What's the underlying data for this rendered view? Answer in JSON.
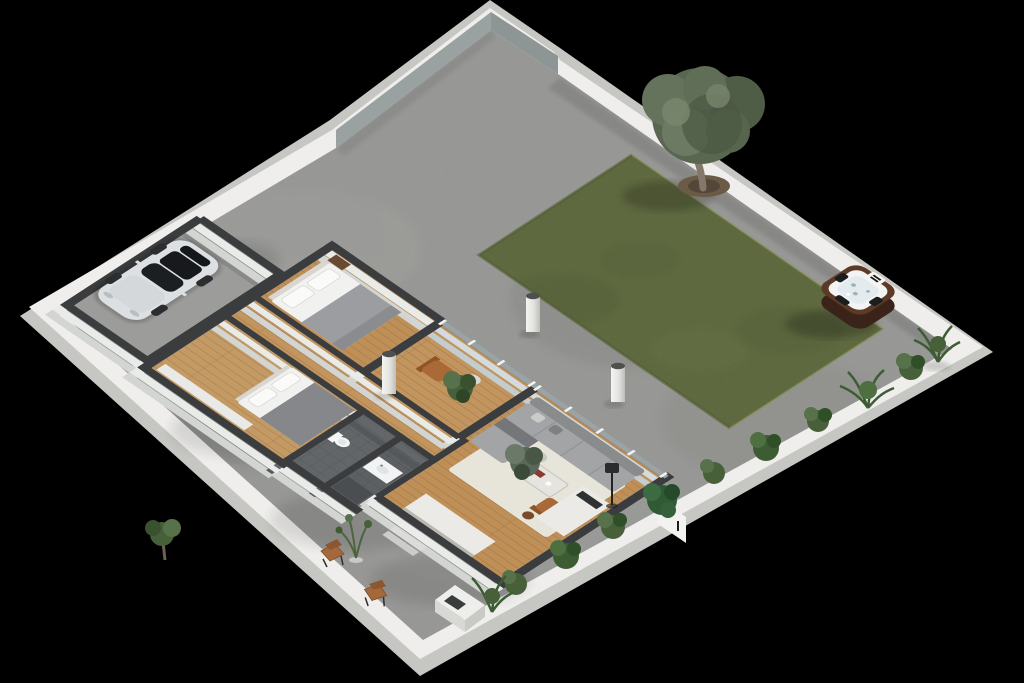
{
  "scene": {
    "type": "3d-isometric-floor-plan-render",
    "view": "Isometric cutaway render of a walled residential lot with house, garage, courtyard, lawn, olive tree and hot tub",
    "background": "#000000",
    "palette": {
      "wall_top": "#efeeec",
      "wall_face": "#c6c6c2",
      "wall_inner_grey": "#8d9595",
      "concrete": "#a8a8a5",
      "grass": "#6f7f3e",
      "grass_dark": "#4c5b2b",
      "tree_canopy": "#5a6750",
      "tree_trunk": "#84786a",
      "soil": "#6b5a45",
      "house_wall_cap": "#3a3c3e",
      "house_wall_face": "#e8eae8",
      "glass": "#c3cdd0",
      "wood_floor": "#bf8f58",
      "bath_tile": "#626668",
      "rug": "#e7e4da",
      "sofa": "#a2a4a6",
      "sofa_back": "#898b8d",
      "linen": "#f1f1ef",
      "blanket": "#9b9da0",
      "blanket_dark": "#85878a",
      "headboard": "#d8d6d2",
      "nightstand": "#6b4a32",
      "leather": "#a96a38",
      "marble": "#eceae6",
      "counter_dark": "#2f3133",
      "car_body": "#dde0e2",
      "car_glass": "#17191c",
      "car_wheel": "#2b2d2f",
      "tub_wood": "#5d3a26",
      "tub_wood_dark": "#3a241a",
      "tub_shell": "#f3f4f4",
      "tub_water": "#e4ebee",
      "tub_pad": "#1b1d1f",
      "plant_green": "#47603a",
      "plant_green_dark": "#2f4f28",
      "plant_green_light": "#57714a",
      "bollard": "#e9e9e7",
      "bollard_top": "#4e5050"
    },
    "rooms": [
      {
        "name": "garage",
        "furniture": [
          "white-car"
        ]
      },
      {
        "name": "master-bedroom",
        "furniture": [
          "double-bed",
          "nightstand"
        ]
      },
      {
        "name": "bedroom-2",
        "furniture": [
          "double-bed",
          "wardrobe"
        ]
      },
      {
        "name": "bathroom",
        "furniture": [
          "toilet"
        ]
      },
      {
        "name": "shower-room",
        "furniture": [
          "vanity-sink",
          "shower"
        ]
      },
      {
        "name": "den",
        "furniture": [
          "leather-chair",
          "potted-plant"
        ]
      },
      {
        "name": "living-room",
        "furniture": [
          "sectional-sofa",
          "coffee-table",
          "leather-armchair",
          "floor-lamp",
          "rug",
          "potted-plant",
          "side-table"
        ]
      },
      {
        "name": "kitchen",
        "furniture": [
          "counter",
          "marble-island",
          "bar-stool"
        ]
      },
      {
        "name": "hallway",
        "furniture": []
      }
    ],
    "exterior": [
      "perimeter-wall",
      "concrete-courtyard",
      "lawn",
      "olive-tree",
      "hot-tub",
      "bollard-lights",
      "border-plants",
      "patio-chairs",
      "outdoor-unit",
      "entry-steps",
      "entry-door"
    ]
  }
}
